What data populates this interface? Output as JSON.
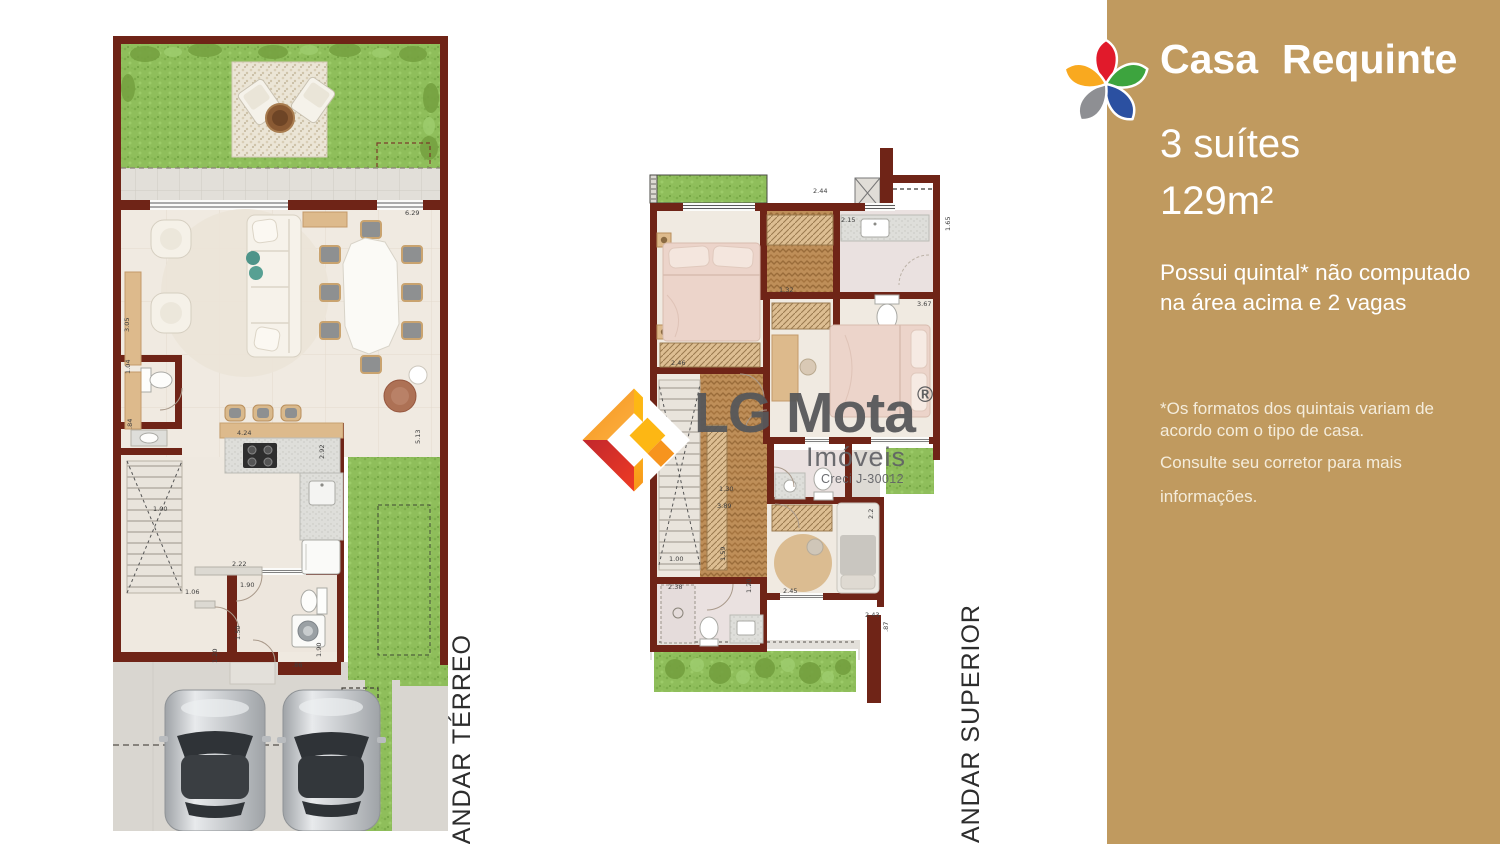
{
  "sidebar": {
    "title_parts": [
      "Casa",
      "Requinte"
    ],
    "suites": "3 suítes",
    "area": "129m²",
    "description": "Possui quintal* não computado na área acima e 2 vagas",
    "notes": [
      "*Os formatos dos quintais variam de",
      "acordo com o tipo de casa.",
      "Consulte seu corretor para mais",
      "informações."
    ],
    "flower_petals": [
      "#E11A2B",
      "#3DA43E",
      "#2B50A1",
      "#8E8F93",
      "#F9A91F"
    ]
  },
  "watermark": {
    "name": "LG Mota",
    "reg": "®",
    "subtitle": "Imóveis",
    "creci": "Creci J-30012"
  },
  "plans": {
    "terreo": {
      "label": "ANDAR TÉRREO",
      "dimensions": [
        {
          "t": "6.29",
          "x": 292,
          "y": 179
        },
        {
          "t": "3.05",
          "x": 16,
          "y": 296,
          "v": 1
        },
        {
          "t": "1.04",
          "x": 17,
          "y": 338,
          "v": 1
        },
        {
          "t": ".84",
          "x": 19,
          "y": 393,
          "v": 1
        },
        {
          "t": "4.24",
          "x": 124,
          "y": 399
        },
        {
          "t": "2.92",
          "x": 211,
          "y": 423,
          "v": 1
        },
        {
          "t": "5.13",
          "x": 307,
          "y": 408,
          "v": 1
        },
        {
          "t": "1.00",
          "x": 40,
          "y": 475
        },
        {
          "t": "2.22",
          "x": 119,
          "y": 530
        },
        {
          "t": "1.90",
          "x": 127,
          "y": 551
        },
        {
          "t": "1.06",
          "x": 72,
          "y": 558
        },
        {
          "t": "1.20",
          "x": 104,
          "y": 627,
          "v": 1
        },
        {
          "t": "1.50",
          "x": 127,
          "y": 604,
          "v": 1
        },
        {
          "t": ".86",
          "x": 179,
          "y": 631
        },
        {
          "t": "1.90",
          "x": 208,
          "y": 621,
          "v": 1
        }
      ]
    },
    "superior": {
      "label": "ANDAR SUPERIOR",
      "dimensions": [
        {
          "t": "2.44",
          "x": 168,
          "y": 48
        },
        {
          "t": "2.15",
          "x": 196,
          "y": 77
        },
        {
          "t": "1.65",
          "x": 305,
          "y": 86,
          "v": 1
        },
        {
          "t": "3.67",
          "x": 272,
          "y": 161
        },
        {
          "t": "1.32",
          "x": 134,
          "y": 147
        },
        {
          "t": "2.46",
          "x": 26,
          "y": 220
        },
        {
          "t": "1.30",
          "x": 74,
          "y": 346
        },
        {
          "t": "3.89",
          "x": 72,
          "y": 363
        },
        {
          "t": "1.00",
          "x": 24,
          "y": 416
        },
        {
          "t": "1.59",
          "x": 80,
          "y": 416,
          "v": 1
        },
        {
          "t": "2.38",
          "x": 23,
          "y": 444
        },
        {
          "t": "1.20",
          "x": 106,
          "y": 448,
          "v": 1
        },
        {
          "t": "2.45",
          "x": 138,
          "y": 448
        },
        {
          "t": "2.2",
          "x": 228,
          "y": 374,
          "v": 1
        },
        {
          "t": "2.43",
          "x": 220,
          "y": 472
        },
        {
          "t": ".87",
          "x": 243,
          "y": 487,
          "v": 1
        }
      ]
    }
  },
  "colors": {
    "sidebar_bg": "#C09A5F",
    "wall": "#6F2417",
    "lawn": "#8FBE5B",
    "wood_floor": "#BE8E58",
    "floor": "#F0EAE1",
    "bath_floor": "#EAE1E0",
    "pavement": "#D9D6D0",
    "watermark_gray": "#56575A",
    "emblem_orange": "#F7941E",
    "emblem_yellow": "#FDB714",
    "emblem_red": "#E8212E",
    "emblem_dark_red": "#C1272D"
  }
}
